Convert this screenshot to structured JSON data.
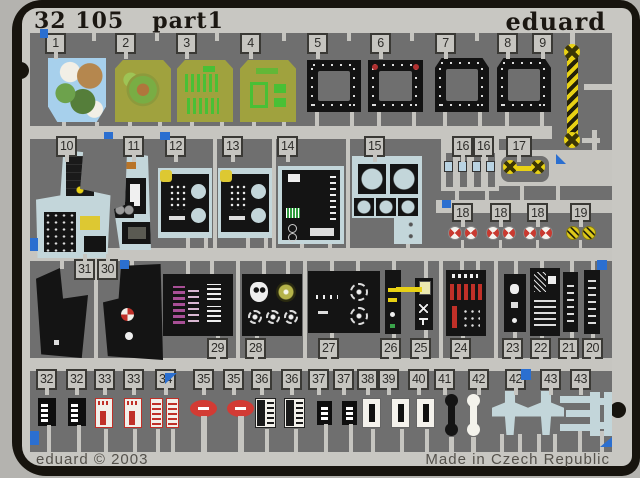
{
  "header": {
    "catalog": "32 105",
    "part_label": "part1",
    "brand": "eduard"
  },
  "footer": {
    "copyright": "eduard © 2003",
    "origin": "Made in Czech Republic"
  },
  "tabs": {
    "row1": [
      "1",
      "2",
      "3",
      "4",
      "5",
      "6",
      "7",
      "8",
      "9"
    ],
    "row2": [
      "10",
      "11",
      "12",
      "13",
      "14",
      "15"
    ],
    "row2b": [
      "16",
      "16",
      "17"
    ],
    "row2c": [
      "18",
      "18",
      "18",
      "19"
    ],
    "row3_top": [
      "31",
      "30"
    ],
    "row3_bottom": [
      "29",
      "28",
      "27",
      "26",
      "25",
      "24",
      "23",
      "22",
      "21",
      "20"
    ],
    "row4": [
      "32",
      "32",
      "33",
      "33",
      "34",
      "35",
      "35",
      "36",
      "36",
      "37",
      "37",
      "38",
      "39",
      "40",
      "41",
      "42",
      "42",
      "43",
      "43"
    ]
  },
  "colors": {
    "sheet": "#c8c7c2",
    "etched_background": "#6f6f6f",
    "frame_black": "#17140e",
    "accent_blue": "#2b6fd0",
    "hazard_yellow": "#e8d114",
    "placard_red": "#c8332e",
    "film_olive": "#a0a23e",
    "film_map_blue": "#a7d0ec",
    "print_green": "#49c035",
    "cockpit_film_blue": "#c3d6da"
  }
}
